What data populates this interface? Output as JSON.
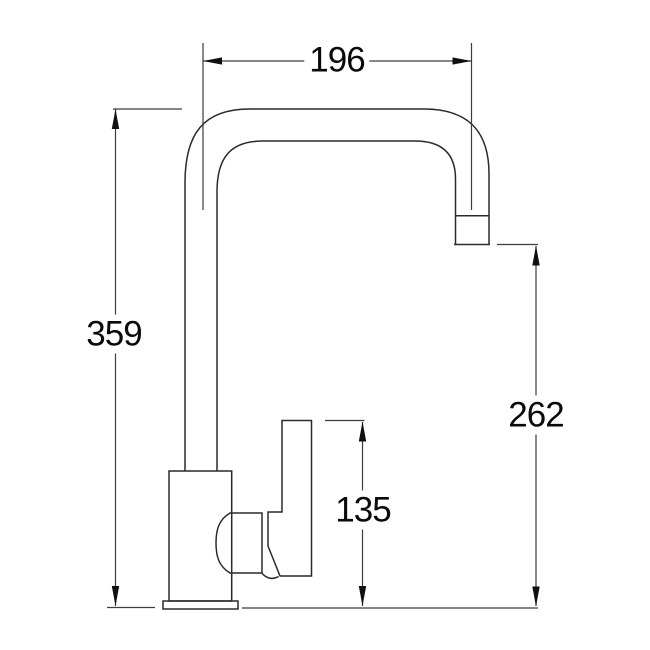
{
  "drawing": {
    "title": "kitchen-mixer-tap-side-elevation",
    "background": "#ffffff"
  },
  "colors": {
    "outline": "#2a2a2a",
    "dimension_line": "#3d3d3d",
    "arrow": "#101010",
    "text": "#0a0a0a"
  },
  "dimensions": {
    "spout_reach": {
      "value": "196",
      "orientation": "horizontal"
    },
    "overall_height": {
      "value": "359",
      "orientation": "vertical"
    },
    "outlet_height": {
      "value": "262",
      "orientation": "vertical"
    },
    "handle_height": {
      "value": "135",
      "orientation": "vertical"
    }
  }
}
